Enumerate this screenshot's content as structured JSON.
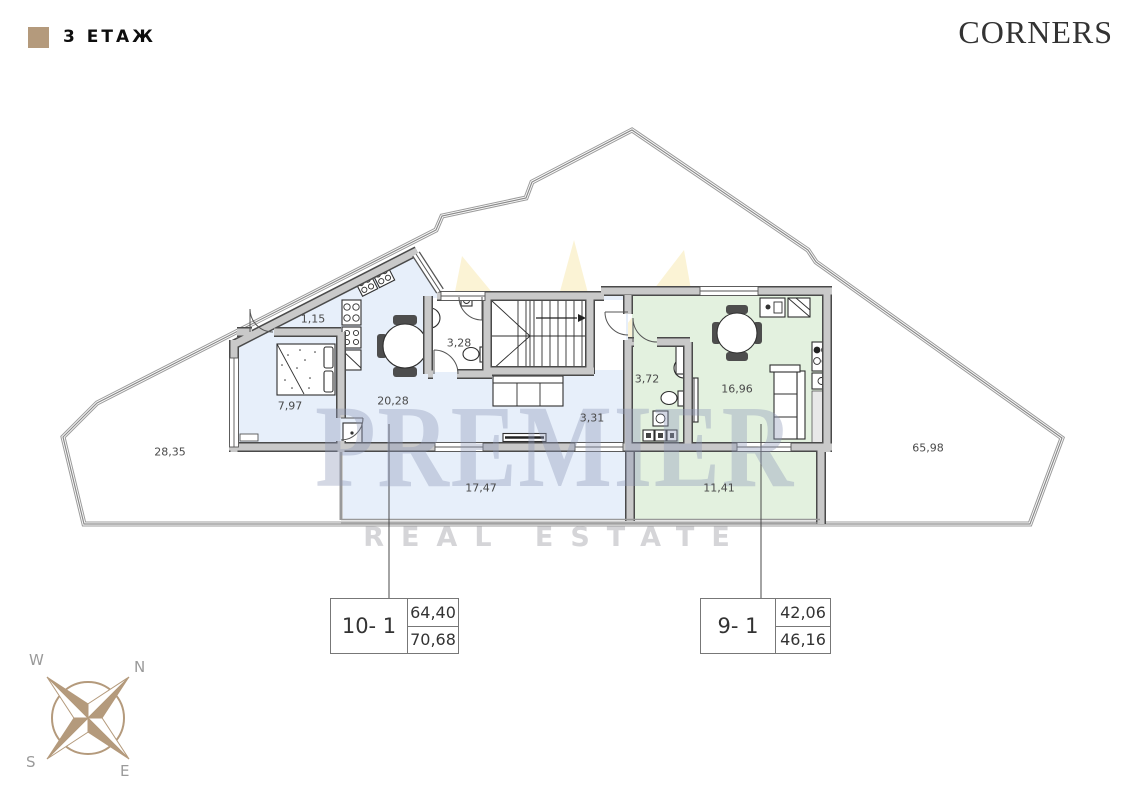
{
  "header": {
    "floor_label": "3 ЕТАЖ",
    "brand": "CORNERS",
    "legend_color": "#b49a7c"
  },
  "watermark": {
    "line1": "PREMIER",
    "line2": "REAL ESTATE",
    "crown_color": "#eec83f"
  },
  "rooms": [
    {
      "name": "terrace-left",
      "area": "28,35"
    },
    {
      "name": "closet",
      "area": "1,15"
    },
    {
      "name": "bedroom",
      "area": "7,97"
    },
    {
      "name": "living-kitchen-left",
      "area": "20,28"
    },
    {
      "name": "bathroom-left",
      "area": "3,28"
    },
    {
      "name": "hallway-left",
      "area": "3,31"
    },
    {
      "name": "terrace-strip-left",
      "area": "17,47"
    },
    {
      "name": "bathroom-right",
      "area": "3,72"
    },
    {
      "name": "living-kitchen-right",
      "area": "16,96"
    },
    {
      "name": "corridor-right",
      "area": "11,41"
    },
    {
      "name": "terrace-right",
      "area": "65,98"
    }
  ],
  "units": [
    {
      "id": "10- 1",
      "area_net": "64,40",
      "area_total": "70,68",
      "fill": "#e7effa"
    },
    {
      "id": "9- 1",
      "area_net": "42,06",
      "area_total": "46,16",
      "fill": "#e3f1df"
    }
  ],
  "compass": {
    "n": "N",
    "s": "S",
    "e": "E",
    "w": "W",
    "color": "#b49a7c"
  }
}
